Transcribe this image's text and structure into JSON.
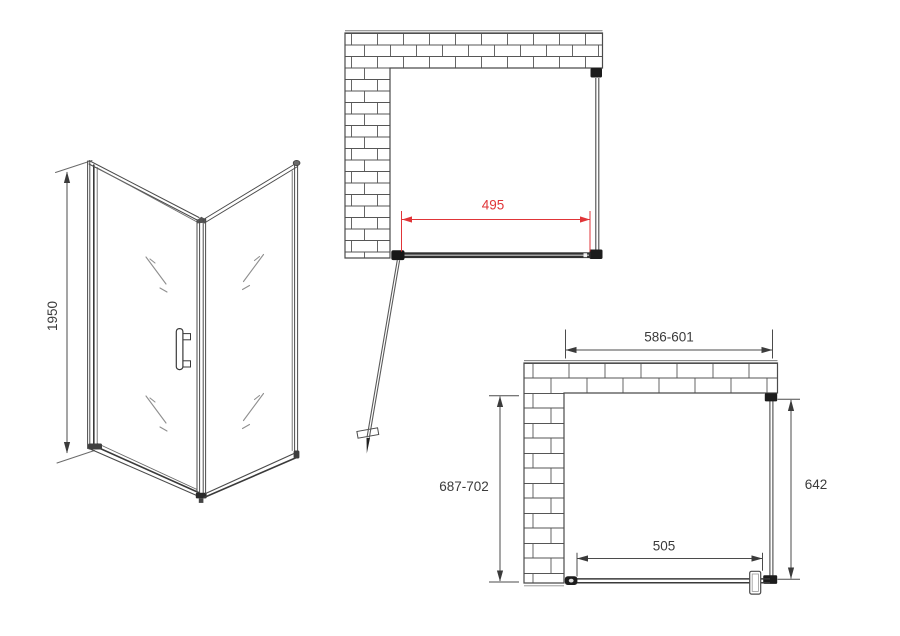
{
  "document": {
    "type": "technical-drawing",
    "subject": "corner shower enclosure with pivot door"
  },
  "colors": {
    "background": "#ffffff",
    "line": "#4b4b4b",
    "dark_fitting": "#1c1c1c",
    "dimension_text": "#3b3b3b",
    "dimension_red": "#e03538"
  },
  "views": {
    "perspective": {
      "height_mm": "1950"
    },
    "plan_open": {
      "door_width_mm": "495"
    },
    "plan_closed": {
      "overall_width_mm": "586-601",
      "overall_depth_mm": "687-702",
      "side_panel_depth_mm": "642",
      "front_width_mm": "505"
    }
  }
}
